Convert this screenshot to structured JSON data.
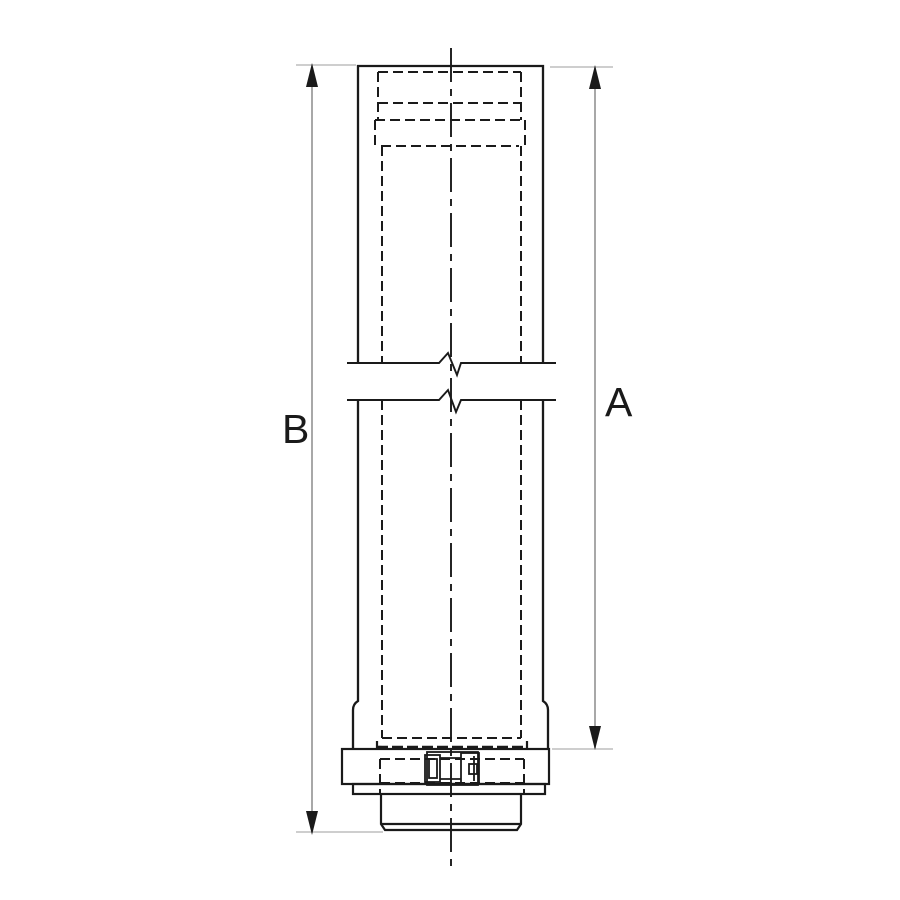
{
  "drawing": {
    "kind": "technical-line-drawing",
    "subject": "vertical pipe section with break lines, locking collar and spigot outlet",
    "labels": {
      "dim_right": "A",
      "dim_left": "B"
    },
    "colors": {
      "line": "#1a1a1a",
      "dimension_line": "#8c8c8c",
      "extension_line": "#bdbdbd",
      "background": "#ffffff"
    }
  }
}
